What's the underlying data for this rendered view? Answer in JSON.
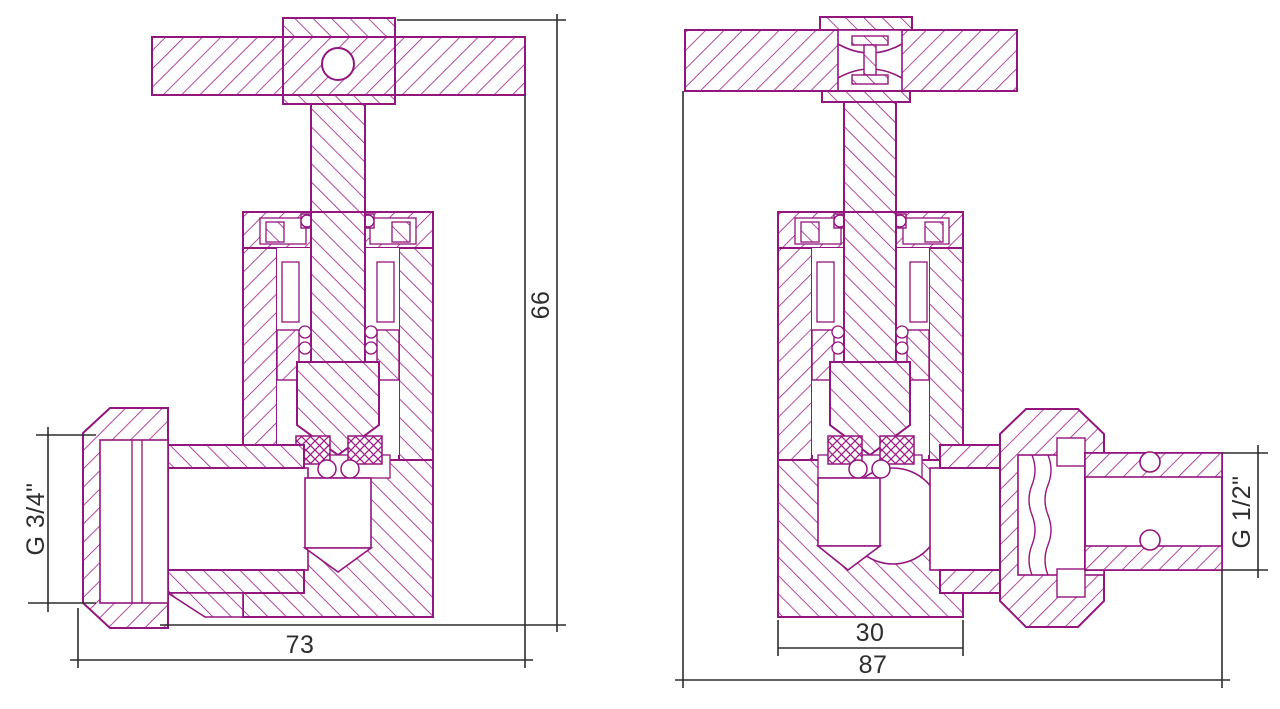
{
  "drawing": {
    "type": "valve-cross-section-technical-drawing",
    "colors": {
      "background": "#ffffff",
      "part_outline": "#93157e",
      "hatch": "#9d1c87",
      "dimension_lines": "#2d2d2d"
    },
    "views": {
      "left_valve": {
        "dimensions": {
          "thread": "G 3/4\"",
          "overall_width": "73",
          "overall_height": "66"
        }
      },
      "right_valve": {
        "dimensions": {
          "body_width": "30",
          "overall_width": "87",
          "thread": "G 1/2\""
        }
      }
    }
  }
}
